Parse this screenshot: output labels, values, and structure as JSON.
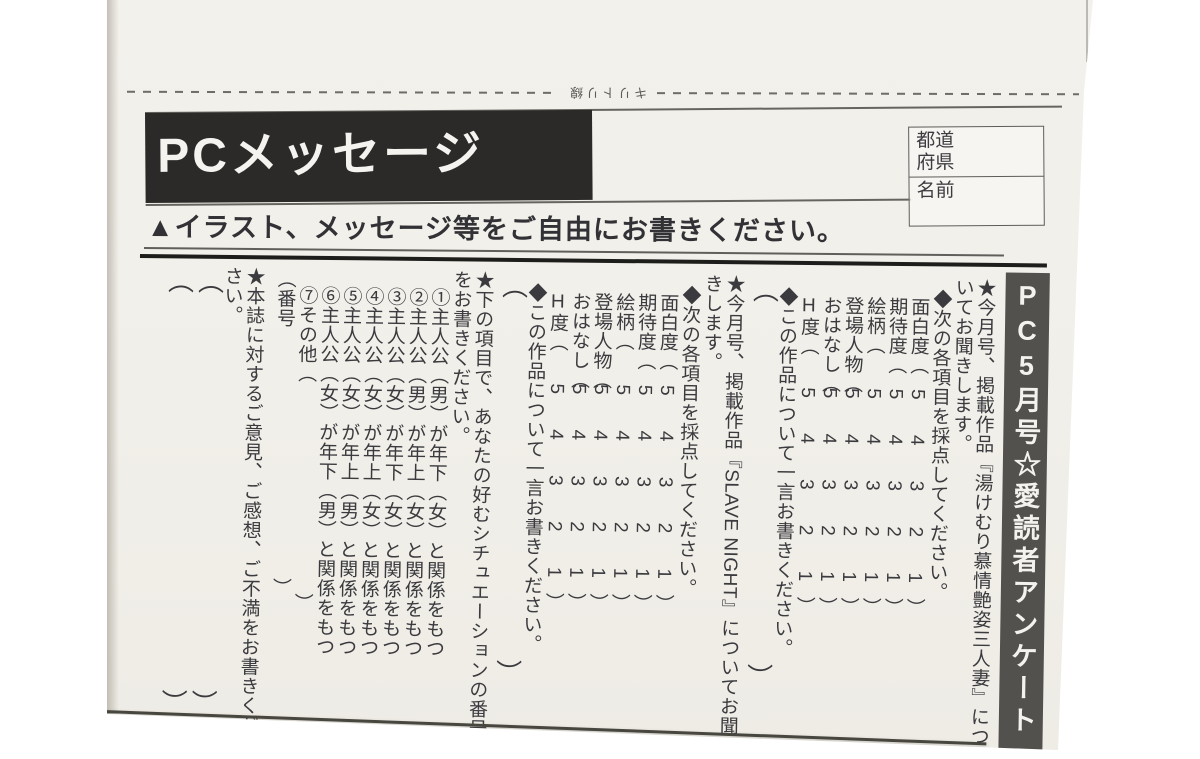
{
  "cut_line": {
    "label": "キリトリ線"
  },
  "header": {
    "title": "PCメッセージ",
    "address_fields": [
      {
        "label": "都道\n府県"
      },
      {
        "label": "名前"
      }
    ]
  },
  "instruction": "▲イラスト、メッセージ等をご自由にお書きください。",
  "banner": "PC5月号☆愛読者アンケート",
  "survey": {
    "scale": "5 4 3 2 1",
    "glyph_open": "（",
    "glyph_close": "）",
    "questions": [
      {
        "heading": "★今月号、掲載作品『湯けむり慕情艶姿三人妻』についてお聞きします。",
        "sub": "◆次の各項目を採点してください。",
        "items": [
          "面白度",
          "期待度",
          "絵柄",
          "登場人物",
          "おはなし",
          "H度"
        ],
        "comment": "◆この作品について一言お書きください。"
      },
      {
        "heading": "★今月号、掲載作品『SLAVE NIGHT』についてお聞きします。",
        "sub": "◆次の各項目を採点してください。",
        "items": [
          "面白度",
          "期待度",
          "絵柄",
          "登場人物",
          "おはなし",
          "H度"
        ],
        "comment": "◆この作品について一言お書きください。"
      }
    ],
    "situations": {
      "heading": "★下の項目で、あなたの好むシチュエーションの番号をお書きください。",
      "options": [
        "①主人公（男）が年下（女）と関係をもつ",
        "②主人公（男）が年上（女）と関係をもつ",
        "③主人公（女）が年下（女）と関係をもつ",
        "④主人公（女）が年上（女）と関係をもつ",
        "⑤主人公（女）が年上（男）と関係をもつ",
        "⑥主人公（女）が年下（男）と関係をもつ",
        "⑦その他（"
      ],
      "answer_prefix": "（番号"
    },
    "feedback": {
      "heading": "★本誌に対するご意見、ご感想、ご不満をお書きください。"
    }
  },
  "colors": {
    "paper": "#f1efe9",
    "header_bar": "#2b2a28",
    "banner_bar": "#53514d",
    "ink": "#3b3b3f"
  }
}
